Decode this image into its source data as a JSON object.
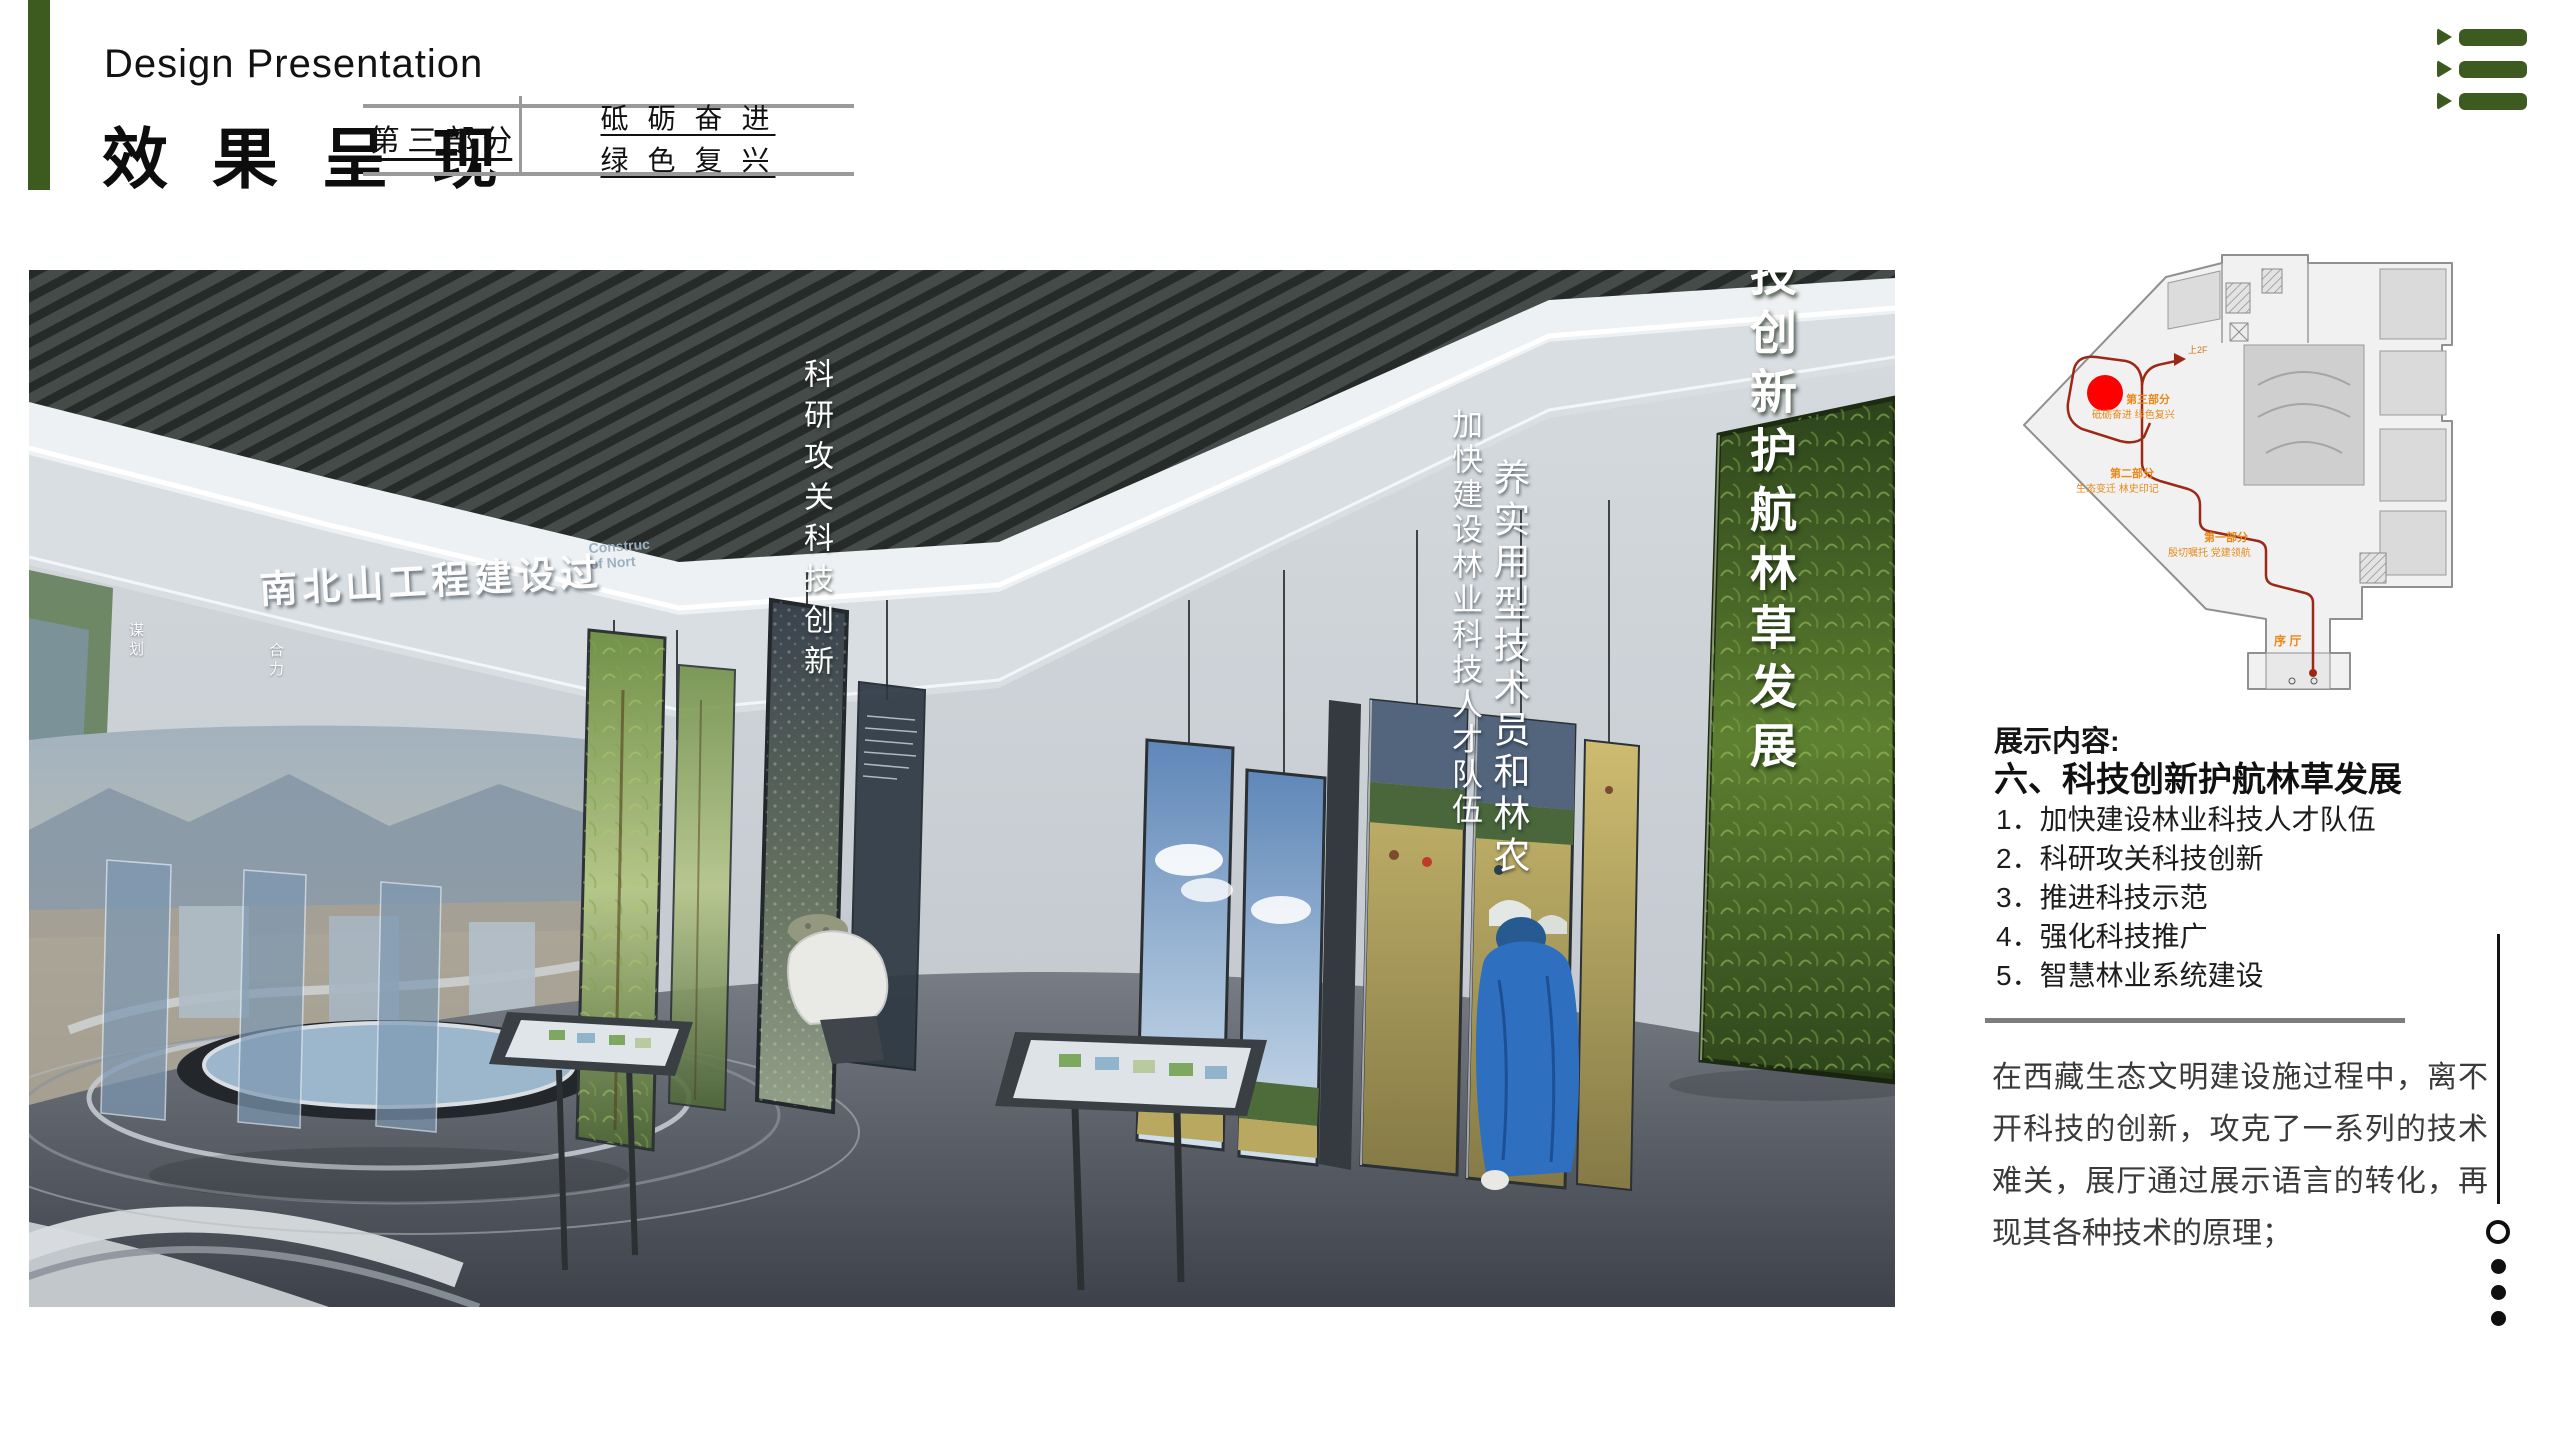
{
  "page": {
    "accent_green": "#3e5b1f"
  },
  "header": {
    "subtitle_en": "Design Presentation",
    "title_cn": "效果呈现",
    "part_table": {
      "part": "第 三 部 分",
      "motto_line1": "砥 砺 奋 进",
      "motto_line2": "绿 色 复 兴"
    }
  },
  "render": {
    "screen_title": "南北山工程建设过",
    "screen_caption_line1": "Construc",
    "screen_caption_line2": "of Nort",
    "glass_panel_labels": [
      "谋划",
      "合力"
    ],
    "vertical_texts": {
      "research": "科研攻关科技创新",
      "talent": "加快建设林业科技人才队伍",
      "training": "养实用型技术员和林农",
      "theme": "科技创新护航林草发展"
    }
  },
  "floorplan": {
    "colors": {
      "route": "#9c2916",
      "marker": "#ff0000",
      "label": "#e8891a"
    },
    "labels": {
      "part3": "第三部分",
      "part3_sub": "砥砺奋进 绿色复兴",
      "part2": "第二部分",
      "part2_sub": "生态变迁 林史印记",
      "part1": "第一部分",
      "part1_sub": "殷切嘱托 党建领航",
      "lobby": "序 厅",
      "to_2f": "上2F"
    }
  },
  "content": {
    "section_label": "展示内容:",
    "section_title": "六、科技创新护航林草发展",
    "items": [
      "1．加快建设林业科技人才队伍",
      "2．科研攻关科技创新",
      "3．推进科技示范",
      "4．强化科技推广",
      "5．智慧林业系统建设"
    ],
    "paragraph": "在西藏生态文明建设施过程中，离不开科技的创新，攻克了一系列的技术难关，展厅通过展示语言的转化，再现其各种技术的原理；"
  }
}
